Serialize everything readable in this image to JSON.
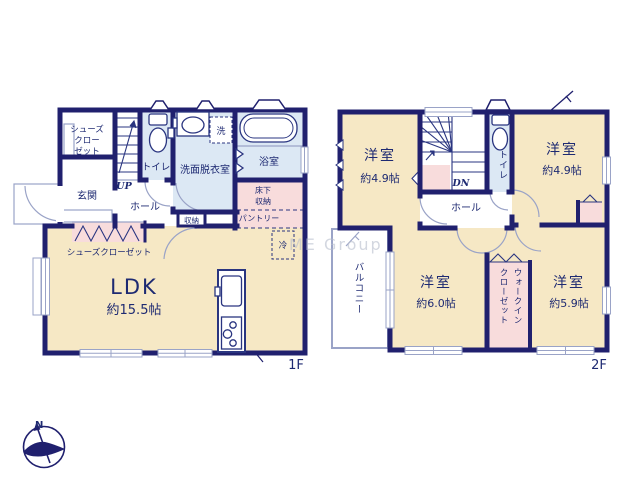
{
  "watermark": "ME Group",
  "compass": {
    "north": "N"
  },
  "colors": {
    "wall": "#20206e",
    "room_cream": "#f6e8c5",
    "wet_blue": "#dce8f4",
    "closet_pink": "#f8dcdc",
    "thin_line": "#9aa3c7",
    "text": "#1e2a72",
    "watermark": "#b7bdcc"
  },
  "floor1": {
    "label": "1F",
    "shoes_closet_upper": {
      "l1": "シューズ",
      "l2": "クロー",
      "l3": "ゼット"
    },
    "entrance": "玄関",
    "stairs": "UP",
    "toilet": "トイレ",
    "washroom": "洗面脱衣室",
    "washer": "洗",
    "bath": "浴室",
    "underfloor": {
      "l1": "床下",
      "l2": "収納"
    },
    "pantry": "パントリー",
    "storage": "収納",
    "hall": "ホール",
    "shoes_closet_lower": "シューズクローゼット",
    "fridge": "冷",
    "ldk": {
      "name": "LDK",
      "size": "約15.5帖"
    }
  },
  "floor2": {
    "label": "2F",
    "bedroom_nw": {
      "name": "洋室",
      "size": "約4.9帖"
    },
    "bedroom_ne": {
      "name": "洋室",
      "size": "約4.9帖"
    },
    "bedroom_sw": {
      "name": "洋室",
      "size": "約6.0帖"
    },
    "bedroom_se": {
      "name": "洋室",
      "size": "約5.9帖"
    },
    "stairs": "DN",
    "toilet": "トイレ",
    "hall": "ホール",
    "balcony": "バルコニー",
    "wic": {
      "l1": "ウォークイン",
      "l2": "クローゼット"
    }
  }
}
